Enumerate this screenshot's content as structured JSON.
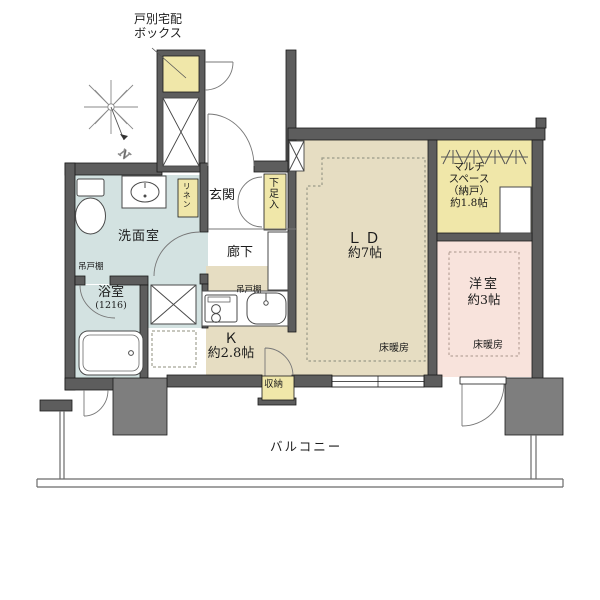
{
  "plan": {
    "delivery_box": {
      "line1": "戸別宅配",
      "line2": "ボックス"
    },
    "compass": {
      "north": "N"
    },
    "entrance": "玄関",
    "shoe_box": "下足入",
    "hallway": "廊下",
    "washroom": "洗面室",
    "linen": "リネン",
    "hanging_cupboard_washroom": "吊戸棚",
    "bathroom": {
      "name": "浴室",
      "size": "(1216)"
    },
    "kitchen": {
      "name": "Ｋ",
      "area": "約2.8帖",
      "hanging_cupboard": "吊戸棚",
      "storage": "収納"
    },
    "living_dining": {
      "name": "ＬＤ",
      "area": "約7帖",
      "floor_heating": "床暖房"
    },
    "multi_space": {
      "line1": "マルチ",
      "line2": "スペース",
      "line3": "（納戸）",
      "line4": "約1.8帖"
    },
    "western_room": {
      "name": "洋室",
      "area": "約3帖",
      "floor_heating": "床暖房"
    },
    "balcony": "バルコニー"
  },
  "colors": {
    "wall": "#5d5d5d",
    "pillar": "#7e7e7e",
    "room_beige": "#e6ddc2",
    "room_blue": "#d3e2e1",
    "room_pink": "#f8e3dc",
    "closet_yellow": "#f0e7a9",
    "outline": "#1a1a1a"
  }
}
